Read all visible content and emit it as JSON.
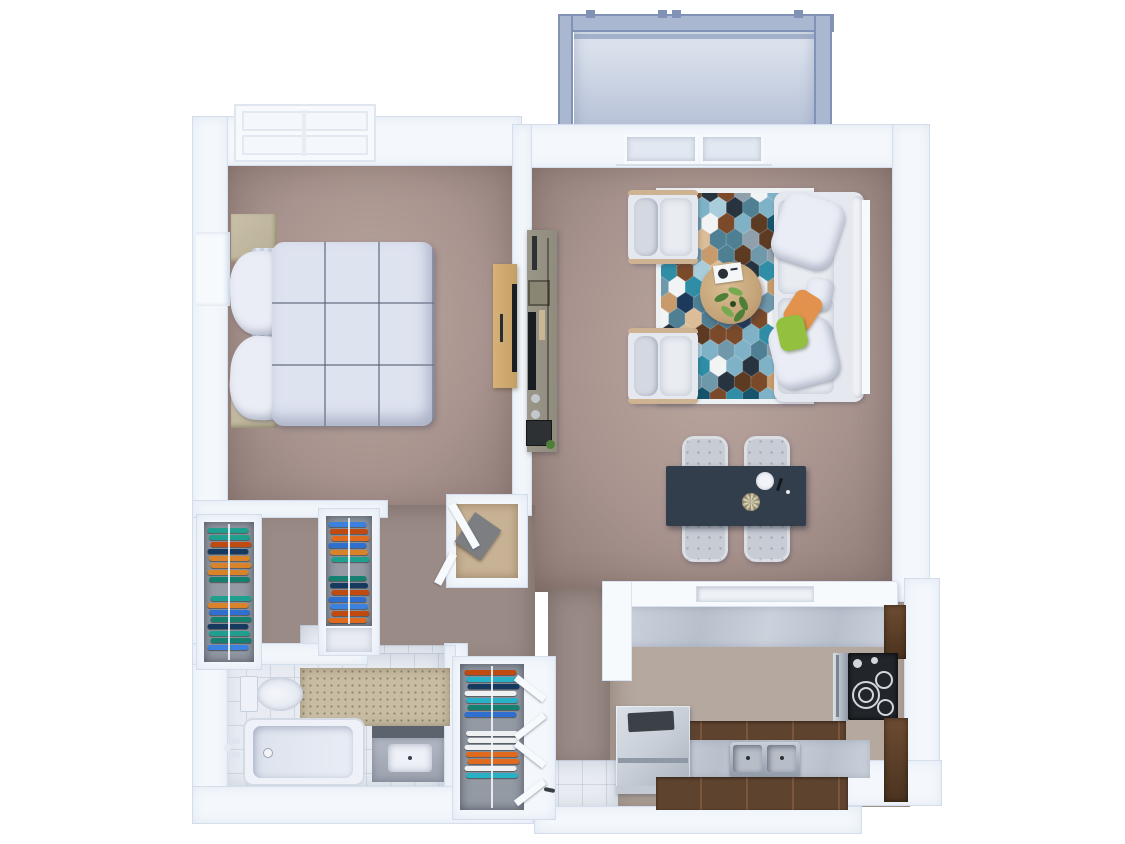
{
  "scene": {
    "type": "3d-floor-plan-top-view",
    "label": "3D top-view floor plan of a one-bedroom apartment with balcony",
    "rooms": [
      "bedroom",
      "living-room",
      "dining-area",
      "kitchen",
      "bathroom",
      "hallway",
      "closets",
      "balcony",
      "entry"
    ]
  },
  "palette": {
    "page_bg": "#ffffff",
    "wall": "#f4f8fc",
    "wall_shade": "#dde5f0",
    "door_white": "#f7fafd",
    "rod_white": "#eff3f9",
    "carpet": "#a8938e",
    "carpet_light": "#bba69f",
    "carpet_dark": "#8d7a76",
    "hall_carpet": "#9a8b87",
    "kitchen_floor": "#b5a89f",
    "tile": "#e8ecf2",
    "balcony_floor": "#b4bfd6",
    "balcony_frame": "#8093b6",
    "balcony_frame_light": "#aab7d0",
    "glass_panel": "#e2e8f1",
    "duvet": "#dee3f0",
    "duvet_line": "#565e74",
    "pillow": "#eaedf5",
    "sheet": "#c9d1e1",
    "nightstand": "#b7ae96",
    "dresser_wood": "#c49e66",
    "dresser_handle": "#2a2d33",
    "console_gray": "#8f8b7d",
    "console_dark": "#2e3134",
    "tv_black": "#1a1d21",
    "remote_tan": "#c8b694",
    "basket": "#8b8574",
    "sofa": "#e5e8ee",
    "sofa_cushion": "#e9ecf1",
    "sofa_shadow": "#c9ced8",
    "sofa_wood": "#cdb392",
    "armchair_back": "#d4d9e1",
    "pillow_orange": "#e2924c",
    "pillow_green": "#93c03e",
    "table_wood": "#c5a479",
    "table_wood_dark": "#a5885e",
    "plant_green": "#4e7f38",
    "plant_green_light": "#77aa4f",
    "rug_border": "#eef1f4",
    "dining_table": "#333e4d",
    "dining_chair": "#c8cdd5",
    "marble": "#ccd2dc",
    "marble_vein": "#b9c0cc",
    "counter_wood": "#5e432f",
    "counter_wood_light": "#7a573c",
    "cabinet_wood": "#4a331f",
    "cabinet_wood_light": "#6d4c31",
    "stove_black": "#22262b",
    "burner": "#d2d7de",
    "steel": "#c9d0d9",
    "steel_dark": "#8f99a6",
    "fridge_hi": "#dbe0e7",
    "fridge_lo": "#a9b1bc",
    "granite": "#c8bda4",
    "granite_dot": "#8f8268",
    "vanity_gray": "#b3b9c4",
    "mirror_dark": "#5d636d",
    "tub_inner": "#dde3ed",
    "fixture_white": "#eef1f7",
    "closet_wall": "#939aa4",
    "closet_wood_floor": "#c8b295"
  },
  "rug": {
    "cols": 9,
    "rows": 13,
    "colors": [
      "#2f8ea6",
      "#15546b",
      "#1d3a5c",
      "#7fb2c6",
      "#a9cddb",
      "#6f98ab",
      "#7a4a2a",
      "#5d3a22",
      "#c79b6b",
      "#dcbd97",
      "#f1f3f5",
      "#8fa0ac",
      "#27343f",
      "#4f7f93"
    ]
  },
  "closets": {
    "clothes_colors": [
      "#2f6fd0",
      "#e06a1e",
      "#1fa08e",
      "#eef0f2",
      "#16395f",
      "#d8832a",
      "#28b0c6",
      "#c14a10",
      "#3b82e0",
      "#157f70"
    ],
    "racks": [
      {
        "name": "left-closet-rack",
        "items": 16
      },
      {
        "name": "middle-closet-rack",
        "items": 13
      },
      {
        "name": "entry-closet-rack",
        "items": 14
      }
    ]
  },
  "furniture": {
    "bedroom": [
      "double-bed",
      "duvet",
      "pillows",
      "nightstand-top",
      "nightstand-bottom",
      "dresser",
      "tv",
      "window"
    ],
    "living_room": [
      "sofa",
      "throw-pillow-orange",
      "throw-pillow-green",
      "armchair-top",
      "armchair-bottom",
      "round-coffee-table",
      "potted-plant",
      "magazine",
      "hexagon-rug",
      "media-console",
      "sliding-glass-door"
    ],
    "dining_area": [
      "dining-table",
      "dining-chairs",
      "plate",
      "bowl"
    ],
    "kitchen": [
      "breakfast-bar",
      "cooktop",
      "oven",
      "double-sink",
      "faucet",
      "refrigerator",
      "wood-cabinets",
      "counters"
    ],
    "bathroom": [
      "toilet",
      "bathtub",
      "vanity-sink",
      "granite-counter",
      "mirror"
    ],
    "balcony": [
      "glass-railing",
      "deck"
    ]
  }
}
